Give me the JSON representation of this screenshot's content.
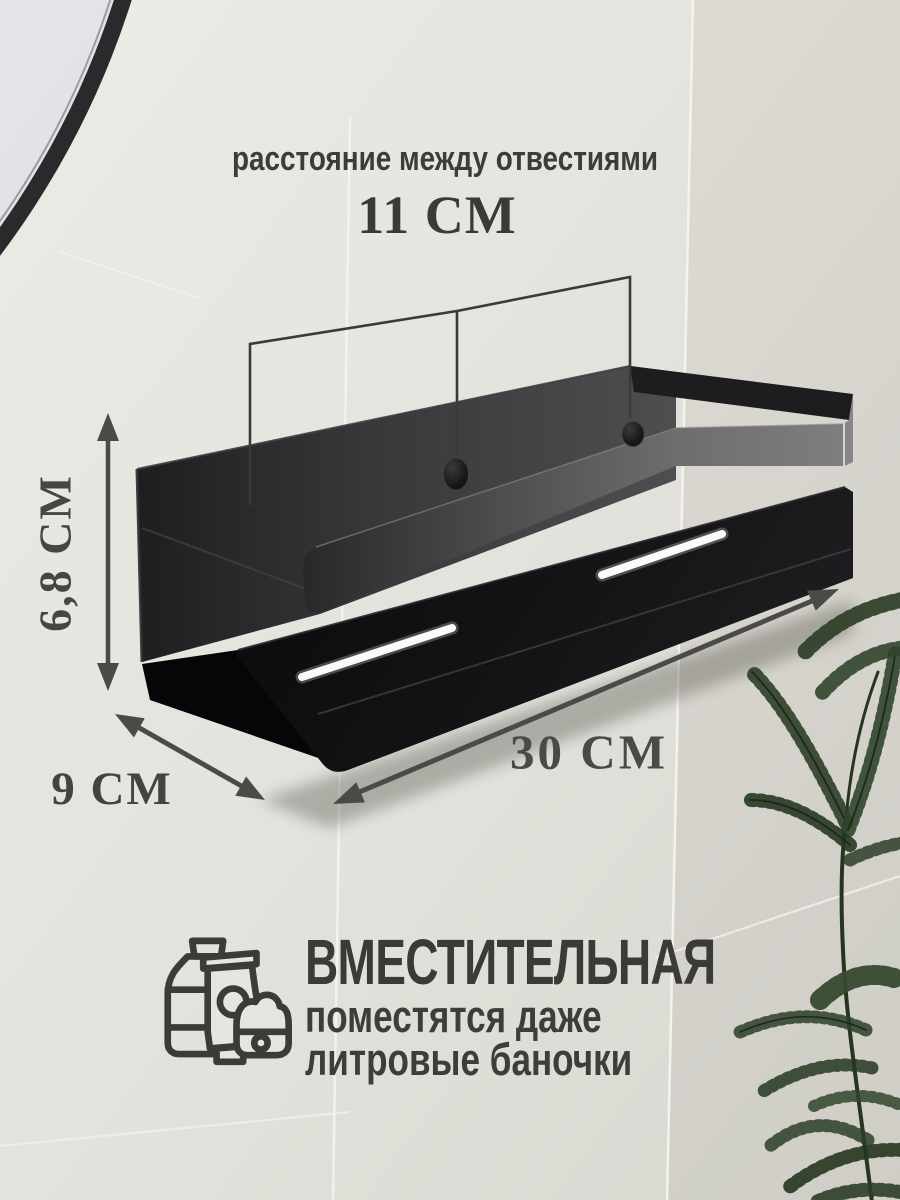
{
  "annotations": {
    "holes": {
      "label": "расстояние между отвестиями",
      "value": "11 СМ"
    },
    "height": {
      "value": "6,8 СМ"
    },
    "depth": {
      "value": "9 СМ"
    },
    "width": {
      "value": "30 СМ"
    }
  },
  "capacity": {
    "title": "ВМЕСТИТЕЛЬНАЯ",
    "line1": "поместятся даже",
    "line2": "литровые баночки"
  },
  "colors": {
    "annotation_text": "#3d3d3b",
    "wall_tile": "#e6e4de",
    "shelf_black": "#121214",
    "shelf_rail_gray": "#707072",
    "slot_highlight": "#fafaf8",
    "plant_green": "#2e3f2b",
    "mirror_frame": "#2a2a2c"
  }
}
